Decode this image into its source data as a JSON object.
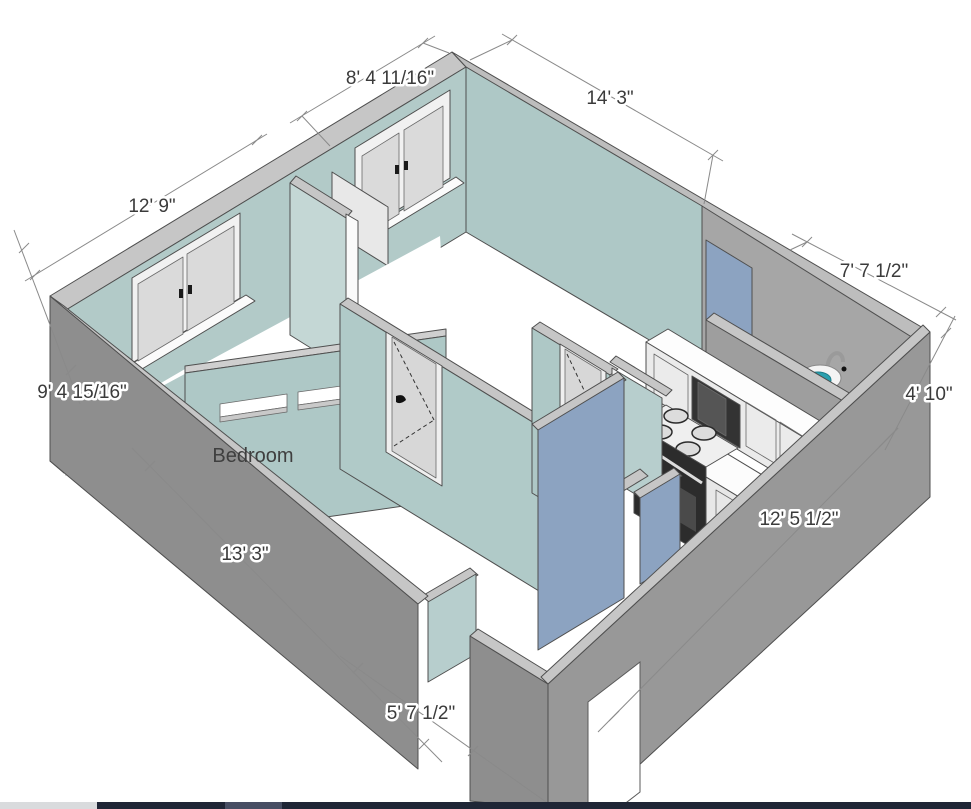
{
  "scene": {
    "type": "3d-floorplan-view",
    "room_label": "Bedroom",
    "dimensions": [
      {
        "id": "back-left-upper-wall",
        "text": "8' 4 11/16\""
      },
      {
        "id": "back-right-wall",
        "text": "14' 3\""
      },
      {
        "id": "left-bedroom-wall",
        "text": "12' 9\""
      },
      {
        "id": "left-side-wall",
        "text": "9' 4 15/16\""
      },
      {
        "id": "bathroom-top-wall",
        "text": "7' 7 1/2\""
      },
      {
        "id": "right-end-wall",
        "text": "4' 10\""
      },
      {
        "id": "front-right-wall",
        "text": "12' 5 1/2\""
      },
      {
        "id": "front-left-wall",
        "text": "13' 3\""
      },
      {
        "id": "entry-wall",
        "text": "5' 7 1/2\""
      }
    ],
    "colors": {
      "wall_interior_teal": "#aec8c6",
      "wall_interior_teal_light": "#c4d7d5",
      "wall_top_band": "#c6c6c6",
      "wall_exterior_gray": "#8e8e8e",
      "wall_exterior_gray_light": "#989898",
      "wall_slate_blue": "#8ca3c1",
      "floor": "#ffffff",
      "dimension_line": "#8a8a8a",
      "text": "#3b3b3b",
      "sink_basin": "#2ba0af",
      "sink_cabinet_wood": "#a26f3e"
    }
  },
  "taskbar": {
    "left_segment_color": "#d9dbdd",
    "bar_color": "#1f2636",
    "active_segment_color": "#474e63"
  }
}
